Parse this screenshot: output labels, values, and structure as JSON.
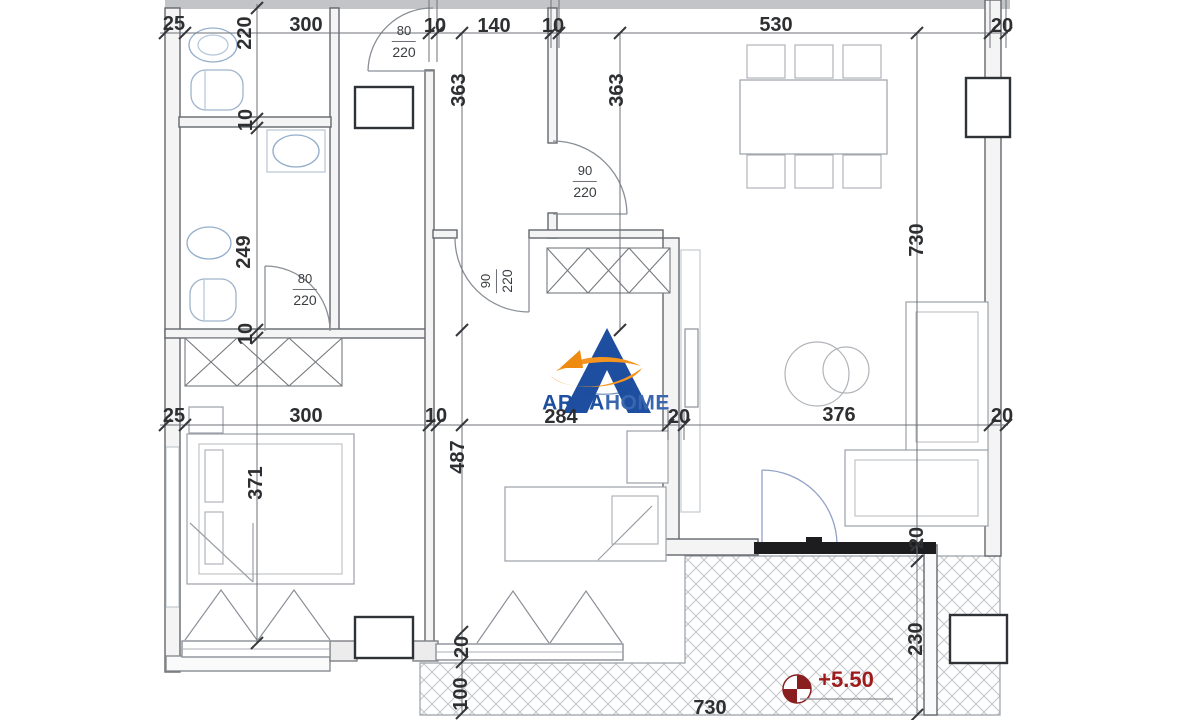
{
  "plan": {
    "logo": {
      "primary": "ARKA",
      "secondary": "HOME"
    },
    "colors": {
      "logo_blue": "#1d4e9f",
      "logo_orange": "#f5941f",
      "level_red": "#9e1b1b",
      "line_dark": "#3a3d40"
    },
    "icons": {
      "level_symbol": "survey-level-marker-icon"
    },
    "labels": [
      {
        "text": "25",
        "x": 174,
        "y": 24
      },
      {
        "text": "300",
        "x": 306,
        "y": 25
      },
      {
        "text": "10",
        "x": 435,
        "y": 26
      },
      {
        "text": "140",
        "x": 494,
        "y": 26
      },
      {
        "text": "10",
        "x": 553,
        "y": 26
      },
      {
        "text": "530",
        "x": 776,
        "y": 25
      },
      {
        "text": "20",
        "x": 1002,
        "y": 26
      },
      {
        "text": "220",
        "x": 245,
        "y": 33,
        "rot": true
      },
      {
        "text": "10",
        "x": 246,
        "y": 120,
        "rot": true
      },
      {
        "text": "249",
        "x": 244,
        "y": 252,
        "rot": true
      },
      {
        "text": "10",
        "x": 246,
        "y": 334,
        "rot": true
      },
      {
        "text": "363",
        "x": 459,
        "y": 90,
        "rot": true
      },
      {
        "text": "363",
        "x": 617,
        "y": 90,
        "rot": true
      },
      {
        "text": "730",
        "x": 917,
        "y": 240,
        "rot": true
      },
      {
        "text": "371",
        "x": 256,
        "y": 483,
        "rot": true
      },
      {
        "text": "487",
        "x": 458,
        "y": 457,
        "rot": true
      },
      {
        "text": "20",
        "x": 462,
        "y": 647,
        "rot": true
      },
      {
        "text": "100",
        "x": 461,
        "y": 694,
        "rot": true
      },
      {
        "text": "20",
        "x": 917,
        "y": 538,
        "rot": true
      },
      {
        "text": "230",
        "x": 916,
        "y": 639,
        "rot": true
      },
      {
        "text": "25",
        "x": 174,
        "y": 416
      },
      {
        "text": "300",
        "x": 306,
        "y": 416
      },
      {
        "text": "10",
        "x": 436,
        "y": 416
      },
      {
        "text": "284",
        "x": 561,
        "y": 417
      },
      {
        "text": "20",
        "x": 679,
        "y": 417
      },
      {
        "text": "376",
        "x": 839,
        "y": 415
      },
      {
        "text": "20",
        "x": 1002,
        "y": 416
      },
      {
        "text": "730",
        "x": 710,
        "y": 708
      },
      {
        "text": "+5.50",
        "x": 846,
        "y": 680,
        "style": "level"
      }
    ],
    "door_labels": [
      {
        "w": "80",
        "h": "220",
        "x": 404,
        "y": 42
      },
      {
        "w": "90",
        "h": "220",
        "x": 585,
        "y": 182
      },
      {
        "w": "80",
        "h": "220",
        "x": 305,
        "y": 290
      },
      {
        "w": "90",
        "h": "220",
        "x": 497,
        "y": 281,
        "rot": true
      }
    ]
  }
}
